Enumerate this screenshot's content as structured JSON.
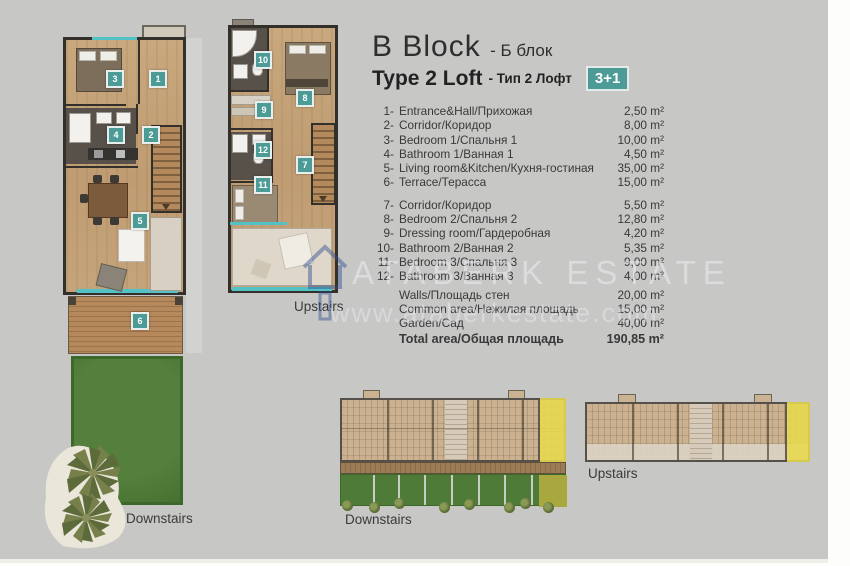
{
  "header": {
    "block_en": "B Block",
    "block_ru": "- Б блок",
    "type_en": "Type 2 Loft",
    "type_ru": "- Тип 2 Лофт",
    "badge": "3+1"
  },
  "rooms": [
    {
      "num": "1-",
      "name": "Entrance&Hall/Прихожая",
      "area": "2,50 m²"
    },
    {
      "num": "2-",
      "name": "Corridor/Коридор",
      "area": "8,00 m²"
    },
    {
      "num": "3-",
      "name": "Bedroom 1/Спальня 1",
      "area": "10,00 m²"
    },
    {
      "num": "4-",
      "name": "Bathroom 1/Ванная 1",
      "area": "4,50 m²"
    },
    {
      "num": "5-",
      "name": "Living room&Kitchen/Кухня-гостиная",
      "area": "35,00 m²"
    },
    {
      "num": "6-",
      "name": "Terrace/Терасса",
      "area": "15,00 m²"
    },
    {
      "num": "7-",
      "name": "Corridor/Коридор",
      "area": "5,50 m²"
    },
    {
      "num": "8-",
      "name": "Bedroom 2/Спальня 2",
      "area": "12,80 m²"
    },
    {
      "num": "9-",
      "name": "Dressing room/Гардеробная",
      "area": "4,20 m²"
    },
    {
      "num": "10-",
      "name": "Bathroom 2/Ванная 2",
      "area": "5,35 m²"
    },
    {
      "num": "11-",
      "name": "Bedroom 3/Спальня 3",
      "area": "9,00 m²"
    },
    {
      "num": "12-",
      "name": "Bathroom 3/Ванная 3",
      "area": "4,00 m²"
    }
  ],
  "summary": [
    {
      "name": "Walls/Площадь стен",
      "area": "20,00 m²"
    },
    {
      "name": "Common area/Нежилая площадь",
      "area": "15,00 m²"
    },
    {
      "name": "Garden/Сад",
      "area": "40,00 m²"
    }
  ],
  "total": {
    "name": "Total area/Общая площадь",
    "area": "190,85 m²"
  },
  "badges": [
    "1",
    "2",
    "3",
    "4",
    "5",
    "6",
    "7",
    "8",
    "9",
    "10",
    "11",
    "12"
  ],
  "labels": {
    "plan_downstairs": "Downstairs",
    "plan_upstairs": "Upstairs",
    "site_downstairs": "Downstairs",
    "site_upstairs": "Upstairs"
  },
  "watermark": {
    "name": "ATABERK ESTATE",
    "url": "www.ataberkestate.com"
  },
  "colors": {
    "accent-teal": "#4d9b97",
    "glass-teal": "#52c2c6",
    "garden-green": "#4e7c38",
    "highlight-yellow": "#e8da4e",
    "wall-dark": "#332f2b"
  }
}
